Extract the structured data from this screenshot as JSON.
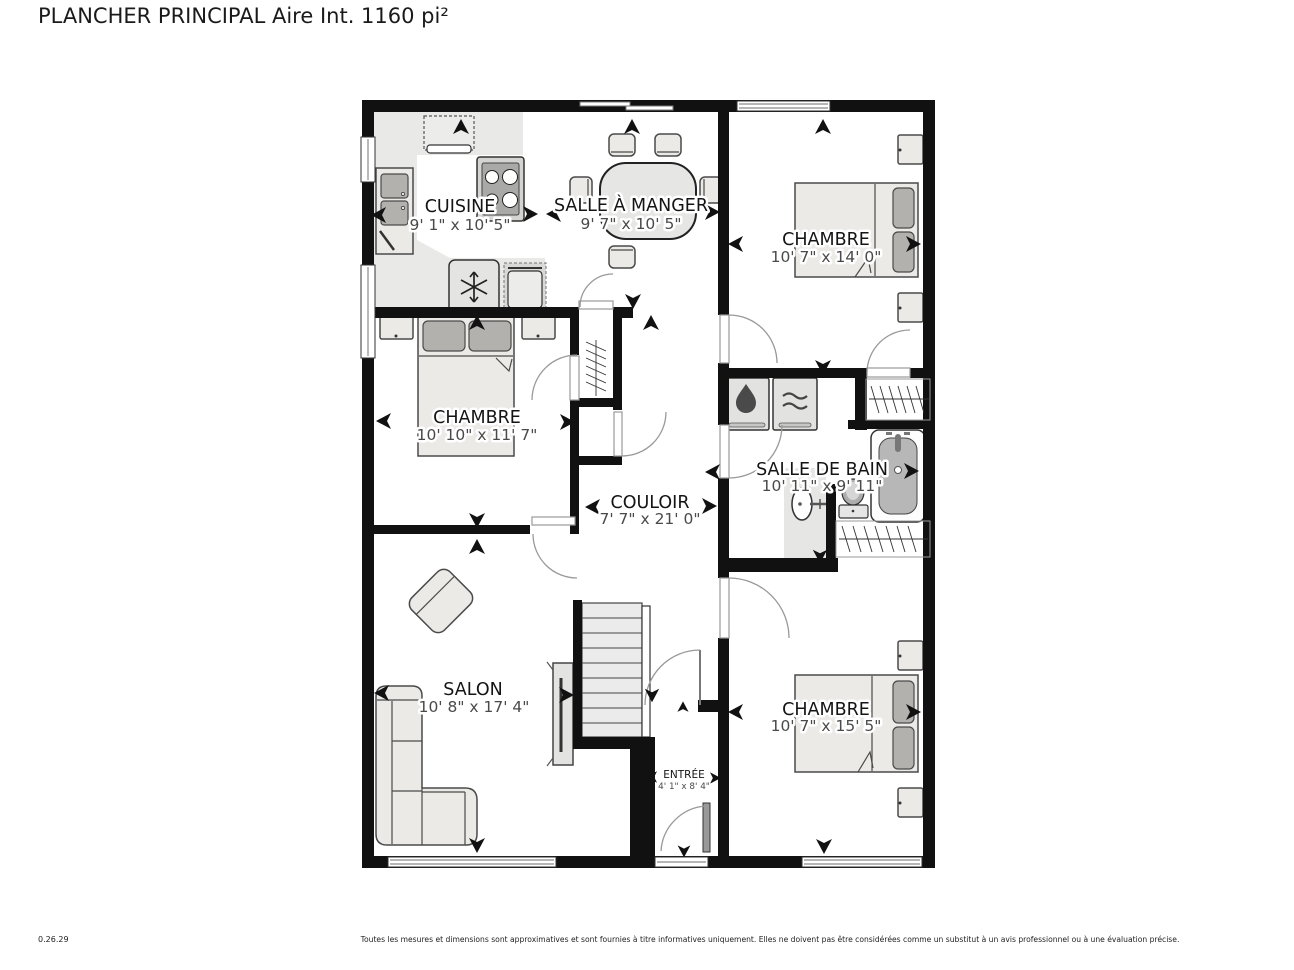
{
  "title": "PLANCHER PRINCIPAL Aire Int. 1160 pi²",
  "footer": {
    "version": "0.26.29",
    "disclaimer": "Toutes les mesures et dimensions sont approximatives et sont fournies à titre informatives uniquement. Elles ne doivent pas être considérées comme un substitut à un avis professionnel ou à une évaluation précise."
  },
  "floor_plan": {
    "rooms": [
      {
        "id": "cuisine",
        "name": "CUISINE",
        "dims": "9' 1\" x 10' 5\""
      },
      {
        "id": "salle-a-manger",
        "name": "SALLE À MANGER",
        "dims": "9' 7\" x 10' 5\""
      },
      {
        "id": "chambre-haut-droite",
        "name": "CHAMBRE",
        "dims": "10' 7\" x 14' 0\""
      },
      {
        "id": "chambre-centre-gauche",
        "name": "CHAMBRE",
        "dims": "10' 10\" x 11' 7\""
      },
      {
        "id": "salle-de-bain",
        "name": "SALLE DE BAIN",
        "dims": "10' 11\" x 9' 11\""
      },
      {
        "id": "couloir",
        "name": "COULOIR",
        "dims": "7' 7\" x 21' 0\""
      },
      {
        "id": "salon",
        "name": "SALON",
        "dims": "10' 8\" x 17' 4\""
      },
      {
        "id": "entree",
        "name": "ENTRÉE",
        "dims": "4' 1\" x 8' 4\""
      },
      {
        "id": "chambre-bas-droite",
        "name": "CHAMBRE",
        "dims": "10' 7\" x 15' 5\""
      }
    ],
    "icons": [
      "snowflake-icon",
      "water-drop-icon",
      "dryer-waves-icon",
      "stove-burners-icon",
      "direction-arrow-icon"
    ],
    "colors": {
      "wall": "#111111",
      "kitchen_floor": "#e9e9e8",
      "furniture_fill": "#eceae7",
      "pillow_fill": "#b3b1ae",
      "bathtub_fill": "#b7b7b7",
      "room_name_text": "#141414",
      "dimension_text": "#4a4a4a"
    }
  }
}
